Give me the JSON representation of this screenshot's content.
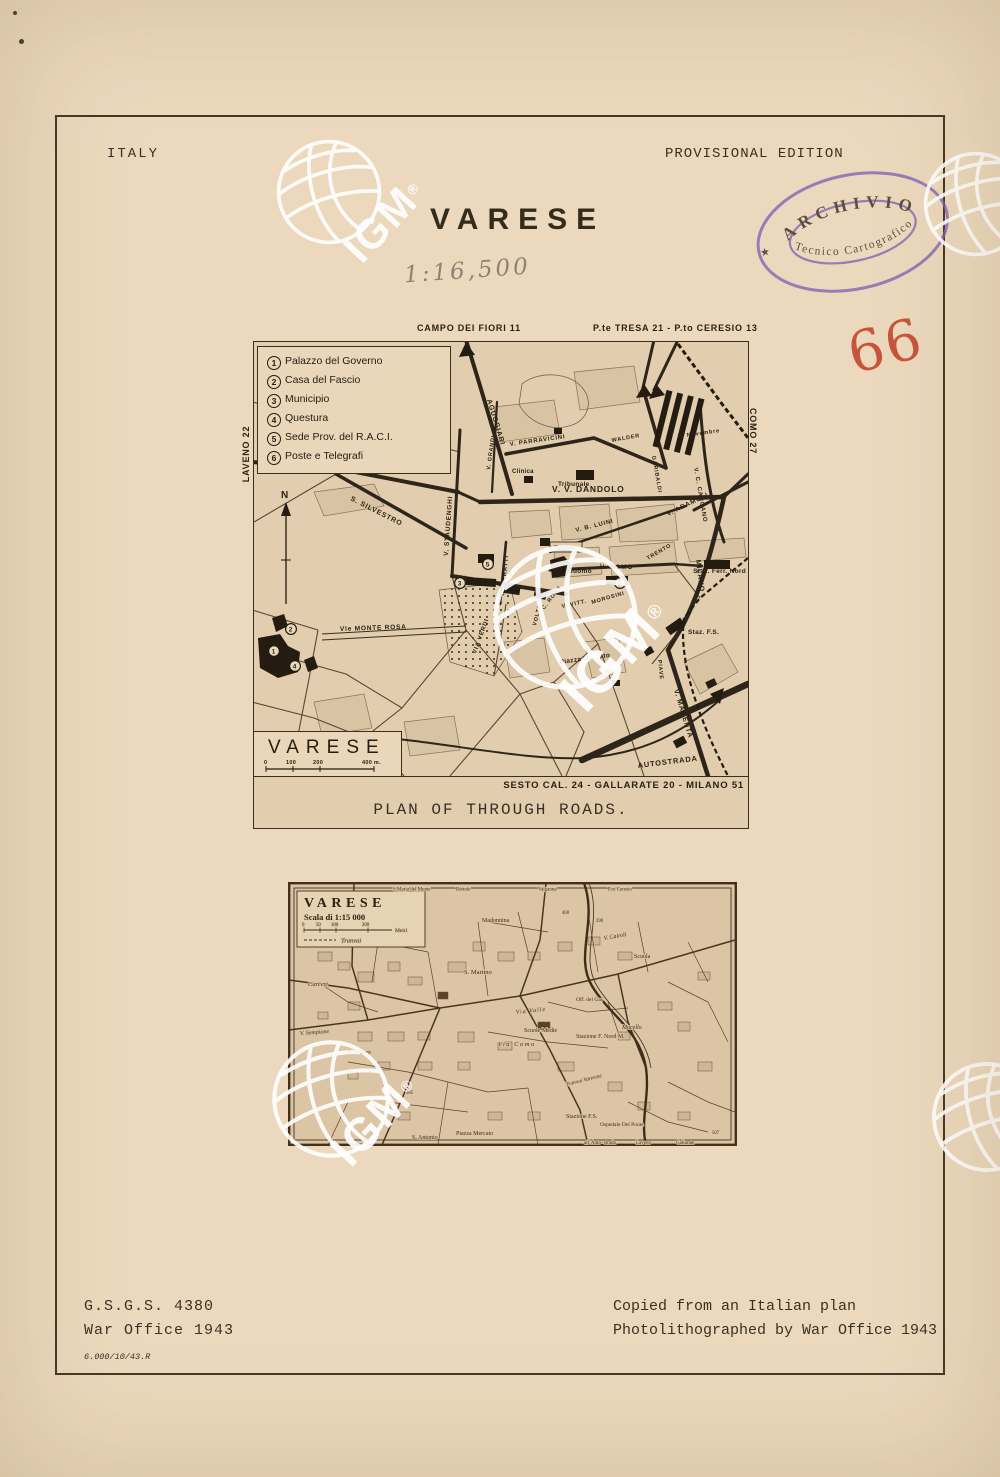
{
  "header": {
    "country": "ITALY",
    "edition": "PROVISIONAL EDITION",
    "title": "VARESE",
    "pencil_scale": "1:16,500",
    "sheet_number": "66"
  },
  "stamp": {
    "top": "ARCHIVIO",
    "bottom": "Tecnico Cartografico",
    "star": "★"
  },
  "watermark": {
    "text": "IGM",
    "reg": "®"
  },
  "map1": {
    "edges": {
      "top_left": "CAMPO DEI FIORI 11",
      "top_right": "P.te TRESA 21 - P.to CERESIO 13",
      "left": "LAVENO 22",
      "right": "COMO 27",
      "bottom_distances": "SESTO CAL. 24 - GALLARATE 20 - MILANO 51",
      "caption": "PLAN OF THROUGH ROADS."
    },
    "compass_n": "N",
    "legend": {
      "numbers": [
        "1",
        "2",
        "3",
        "4",
        "5",
        "6"
      ],
      "items": [
        "Palazzo del Governo",
        "Casa del Fascio",
        "Municipio",
        "Questura",
        "Sede Prov. del R.A.C.I.",
        "Poste e Telegrafi"
      ]
    },
    "title_box": {
      "name": "VARESE",
      "ticks": [
        "0",
        "100",
        "200",
        "400 m."
      ]
    },
    "streets": [
      "AGUGGIARI",
      "V. PARRAVICINI",
      "V. V. DANDOLO",
      "V. B. LUINI",
      "V. ADAMOLI",
      "V. C. CARCANO",
      "WALDER",
      "GARIBALDI",
      "IV Novembre",
      "V. SEMPIONE",
      "S. SILVESTRO",
      "V. STAUDENGHI",
      "V. GRANDI",
      "C. VERATTI",
      "V. L. SACCO",
      "Vle MONTE ROSA",
      "VIA VERDI",
      "MILANO",
      "V. MAGENTA",
      "PIAVE",
      "V. COMO",
      "VOLTA",
      "C. ROMA",
      "V. VITT.",
      "MOROSINI",
      "TRENTO",
      "AUTOSTRADA"
    ],
    "places": [
      "Clinica",
      "Tribunale",
      "Teatro",
      "Duomo",
      "Staz. Ferr. Nord",
      "Staz. F.S.",
      "Piazza Mercato"
    ],
    "markers": [
      "1",
      "2",
      "3",
      "4",
      "5",
      "6"
    ]
  },
  "map2": {
    "title": "VARESE",
    "scale": "Scala di 1:15 000",
    "scale_ticks": [
      "0",
      "50",
      "100",
      "200"
    ],
    "scale_unit": "Metri",
    "tram": "Tranvai",
    "edge_top": [
      "S.Maria del Monte",
      "Bèttole",
      "Valganna",
      "P.to Ceresio"
    ],
    "edge_bottom": [
      "all' Auto- strada",
      "Laveno",
      "Gallarate"
    ],
    "labels": [
      "Carceri",
      "V. Sempione",
      "S. Vittore",
      "S. Martino",
      "Madonnina",
      "V. Cairoli",
      "Scuola",
      "Via Como",
      "Via Valle",
      "Scuole Medie",
      "Stazione F. Nord M.",
      "Macello",
      "Off. del Gas",
      "Tranvai Varesine",
      "Piazza Mercato",
      "S. Antonio",
      "Stazione F.S.",
      "Ospedale Del Ponte"
    ],
    "heights": [
      "390",
      "400",
      "385",
      "507"
    ]
  },
  "footer": {
    "series": "G.S.G.S. 4380",
    "office": "War Office 1943",
    "print_code": "6.000/10/43.R",
    "credit1": "Copied from an Italian plan",
    "credit2": "Photolithographed by War Office 1943"
  }
}
